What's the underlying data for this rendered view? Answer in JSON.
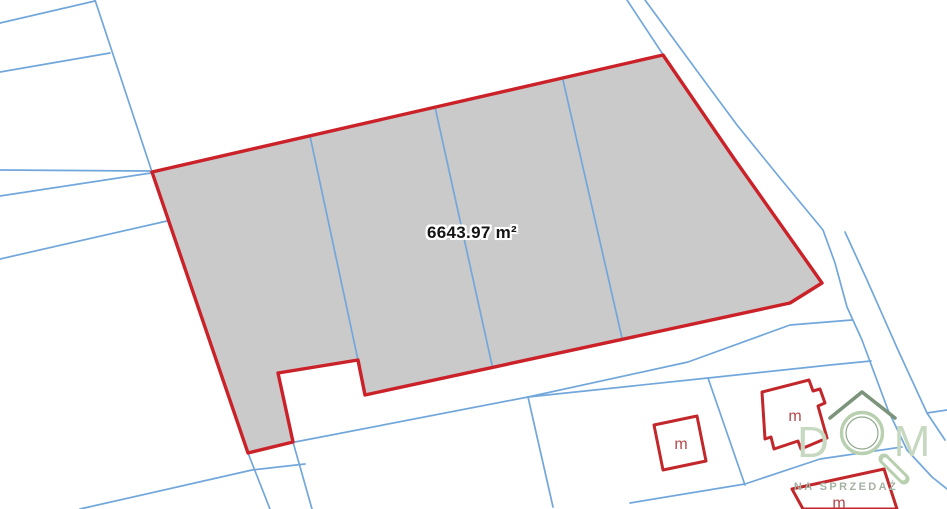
{
  "canvas": {
    "width": 947,
    "height": 509,
    "background": "#ffffff"
  },
  "colors": {
    "parcel_fill": "#cacaca",
    "parcel_stroke": "#cb2129",
    "boundary_blue": "#72a7db",
    "building_red": "#c2272b",
    "building_label": "#b5484a",
    "area_label_text": "#141414",
    "area_label_halo": "#ffffff",
    "logo_roof": "#7c947c",
    "logo_glass": "#b8d0af",
    "logo_glass_inner": "#8fa98b",
    "logo_letters": "#c6d9c0",
    "logo_caption": "#a4b2a4",
    "white": "#ffffff"
  },
  "area_label": {
    "text": "6643.97 m²",
    "x": 472,
    "y": 233
  },
  "parcel": {
    "points": "152,172 663,55 735,160 822,283 790,303 365,395 358,360 278,373 293,442 248,453",
    "stroke_width": 3.4
  },
  "inner_dividers": [
    {
      "points": "310,136 358,360"
    },
    {
      "points": "435,107 492,365"
    },
    {
      "points": "563,80 622,338"
    }
  ],
  "boundary_lines": [
    {
      "name": "row-line",
      "points": "0,23 95,1"
    },
    {
      "name": "diagonal-line",
      "points": "95,0 152,172"
    },
    {
      "name": "row-line",
      "points": "0,72 110,53"
    },
    {
      "name": "row-line",
      "points": "0,170 150,171"
    },
    {
      "name": "row-line",
      "points": "0,196 151,173"
    },
    {
      "name": "row-line",
      "points": "0,259 167,221"
    },
    {
      "name": "road-line",
      "points": "627,0 662,53"
    },
    {
      "name": "road-line",
      "points": "645,0 700,75 737,125 780,178 823,230 835,263 847,307 862,340 888,410 907,450 932,477 947,489"
    },
    {
      "name": "road-line",
      "points": "845,232 867,280 898,350 927,413 945,440"
    },
    {
      "name": "strip-line",
      "points": "295,442 528,397 688,362 790,325 852,320"
    },
    {
      "name": "strip-line",
      "points": "528,397 708,378 830,365 871,361"
    },
    {
      "name": "lot-line",
      "points": "248,453 270,509"
    },
    {
      "name": "lot-line",
      "points": "293,442 312,509"
    },
    {
      "name": "row-line",
      "points": "80,509 252,470 305,464"
    },
    {
      "name": "lot-divider",
      "points": "528,397 553,507"
    },
    {
      "name": "lot-divider",
      "points": "708,378 745,485"
    },
    {
      "name": "row-line",
      "points": "630,503 745,484 820,459 902,447"
    },
    {
      "name": "row-line",
      "points": "927,413 947,410"
    }
  ],
  "buildings": [
    {
      "points": "654,425 697,416 706,461 663,470",
      "label": "m",
      "lx": 681,
      "ly": 449
    },
    {
      "points": "762,392 809,380 813,391 820,389 825,403 818,406 827,438 801,449 798,441 774,449 771,437 765,439",
      "label": "m",
      "lx": 795,
      "ly": 421
    },
    {
      "points": "792,489 884,469 897,509 803,509",
      "label": "m",
      "lx": 839,
      "ly": 508
    }
  ],
  "logo": {
    "letter_d": "D",
    "letter_m": "M",
    "caption": "NA SPRZEDAŻ",
    "letter_d_pos": {
      "x": 813,
      "y": 443
    },
    "letter_m_pos": {
      "x": 912,
      "y": 442
    },
    "caption_pos": {
      "x": 846,
      "y": 487
    },
    "roof_points": "830,418 862,392 895,418",
    "circle": {
      "cx": 862,
      "cy": 433,
      "r": 20.5,
      "r_inner": 16
    },
    "handle": {
      "x1": 884,
      "y1": 459,
      "x2": 904,
      "y2": 479
    }
  }
}
